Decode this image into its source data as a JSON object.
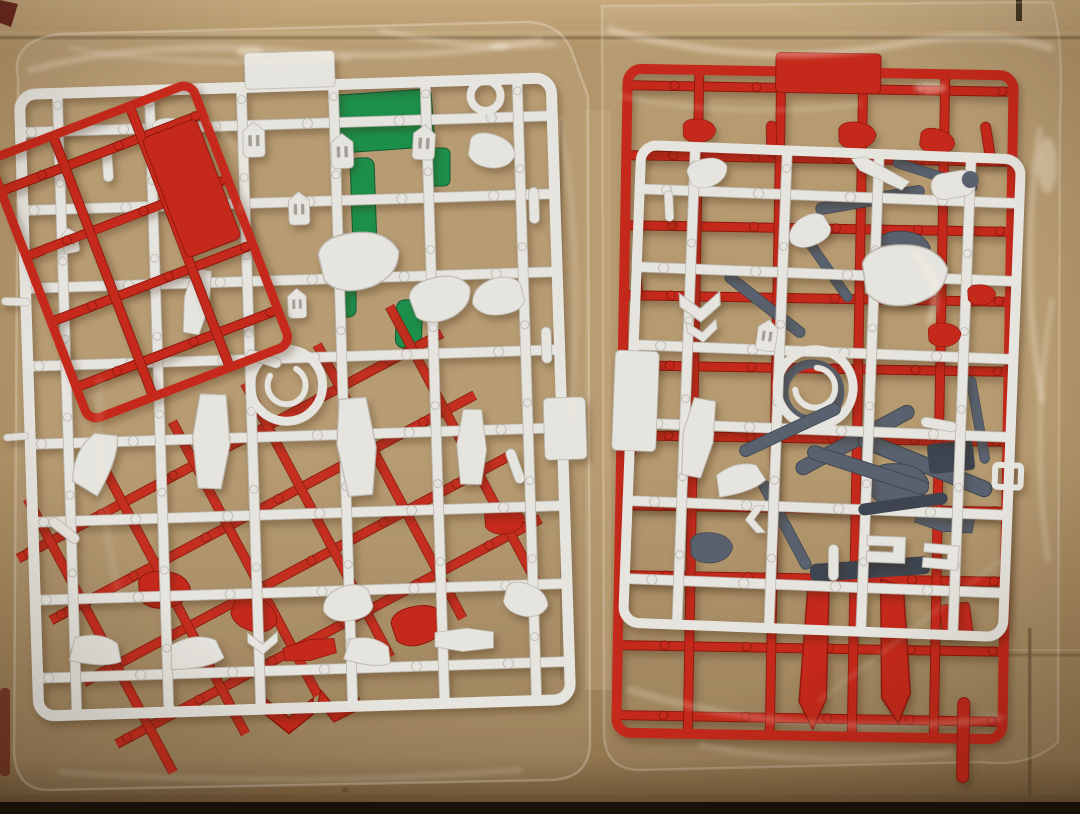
{
  "meta": {
    "type": "photograph",
    "subject": "Two plastic model-kit runners (sprues) sealed in clear plastic bags lying on a cardboard surface",
    "text_visible": "none"
  },
  "css_vars": {
    "cardboard": "#b2956a",
    "cardboard-light": "#c6aa7e",
    "cardboard-mid": "#b2956a",
    "cardboard-dark": "#977b53",
    "cardboard-shadow": "#6b5435",
    "cardboard-edge": "#17110a",
    "white-plastic": "#e6e4de",
    "white-plastic-bright": "#f4f3ef",
    "white-plastic-shadow": "#bab6ae",
    "red-plastic": "#c5291b",
    "red-plastic-dark": "#8e170c",
    "red-plastic-bright": "#e04a38",
    "green-plastic": "#0f9048",
    "green-plastic-dark": "#07542c",
    "gray-plastic": "#58616d",
    "gray-plastic-dark": "#3e4550",
    "slit": "#a29e95",
    "sheen": "#fff6e6",
    "maroon-mark": "#5e1410"
  },
  "objects": {
    "background": {
      "name": "cardboard-surface",
      "material": "corrugated cardboard",
      "features": [
        "horizontal crease near top",
        "vertical seam lower right",
        "dark strip at bottom edge"
      ]
    },
    "left_bag": {
      "name": "left-parts-bag",
      "material": "clear polybag",
      "contents": [
        "white runner lattice with armor, leg and vent parts",
        "red runner underneath with corner flipped on top at upper-left",
        "clear green runner visible through gaps",
        "red chevron parts peeking below bottom rail"
      ]
    },
    "right_bag": {
      "name": "right-parts-bag",
      "material": "clear polybag",
      "contents": [
        "red runner with solid tab at top and two red fin blades at bottom",
        "white runner lying on top with ring and armor parts",
        "dark gray frame parts tangled in middle"
      ]
    }
  }
}
